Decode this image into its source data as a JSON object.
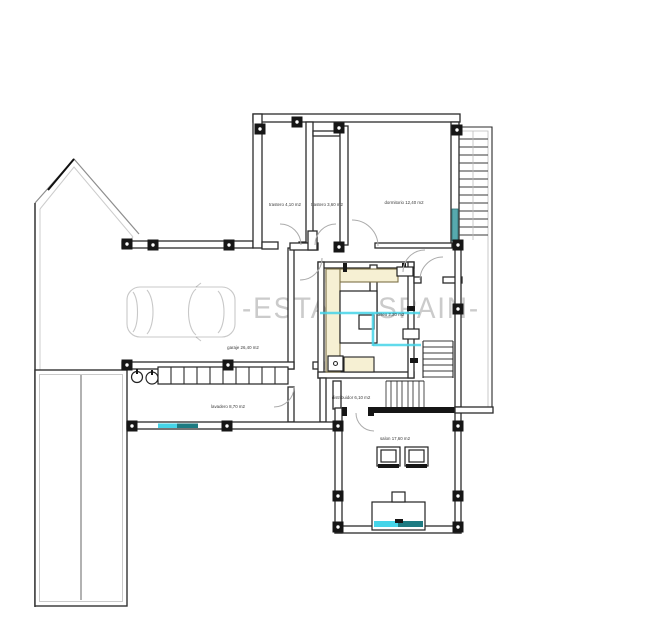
{
  "watermark": {
    "text": "-ESTATE SPAIN-",
    "icon": "car-top-view-watermark"
  },
  "colors": {
    "background": "#ffffff",
    "wall": "#2b2b2b",
    "boundary_gray": "#c9c9c9",
    "watermark": "#cbcbcb",
    "counter_fill": "#f6f0d3",
    "highlight_cyan": "#45d4e8",
    "teal_dark": "#1d7b82",
    "window_teal": "#57a9ae"
  },
  "rooms": {
    "trastero1": {
      "label": "trastero 4,10 m2"
    },
    "trastero2": {
      "label": "trastero 3,60 m2"
    },
    "dormitorio": {
      "label": "dormitorio 12,40 m2"
    },
    "aseo": {
      "label": "aseo 2,20 m2"
    },
    "garaje": {
      "label": "garaje 26,40 m2"
    },
    "lavadero": {
      "label": "lavadero 8,70 m2"
    },
    "distribuidor": {
      "label": "distribuidor 6,10 m2"
    },
    "salon": {
      "label": "salon 17,60 m2"
    }
  },
  "icons": {
    "car": "car-top-view-watermark",
    "washer": "washing-machine-circle",
    "pillar": "column-square-dot",
    "stairs": "stair-steps"
  }
}
